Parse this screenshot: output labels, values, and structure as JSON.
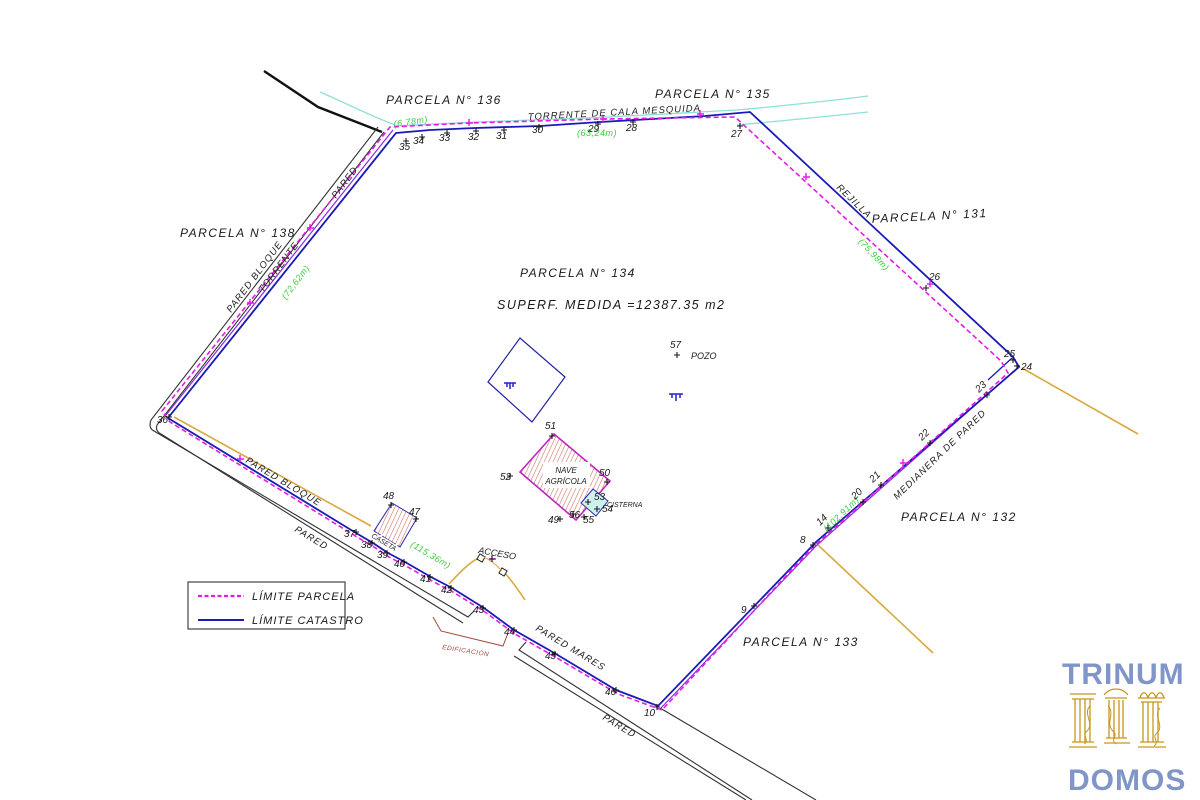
{
  "colors": {
    "limite_parcela": "#e61ae6",
    "limite_catastro": "#1a1ab8",
    "violet_overlap": "#8a2be2",
    "stream_cyan": "#8fe0d8",
    "wall_yellow": "#d9a93f",
    "measure_green": "#3ecc3e",
    "hatch_red": "#cc6a5c",
    "edificacion_red": "#a14a3a",
    "road_black": "#333333",
    "logo_blue": "#8095c8",
    "logo_gold": "#c8961e"
  },
  "parcels": [
    {
      "t": "PARCELA N° 136",
      "x": 386,
      "y": 104,
      "r": 0
    },
    {
      "t": "PARCELA N° 135",
      "x": 655,
      "y": 98,
      "r": 0
    },
    {
      "t": "PARCELA N° 131",
      "x": 872,
      "y": 223,
      "r": -3
    },
    {
      "t": "PARCELA N° 138",
      "x": 180,
      "y": 237,
      "r": 0
    },
    {
      "t": "PARCELA N° 134",
      "x": 520,
      "y": 277,
      "r": 0
    },
    {
      "t": "PARCELA N° 132",
      "x": 901,
      "y": 521,
      "r": 0
    },
    {
      "t": "PARCELA N° 133",
      "x": 743,
      "y": 646,
      "r": 0
    }
  ],
  "superf": "SUPERF.  MEDIDA  =12387.35  m2",
  "labels": [
    {
      "t": "TORRENTE  DE  CALA  MESQUIDA",
      "x": 528,
      "y": 120,
      "r": -3
    },
    {
      "t": "PARED",
      "x": 336,
      "y": 199,
      "r": -53
    },
    {
      "t": "TORRENTE",
      "x": 263,
      "y": 293,
      "r": -53
    },
    {
      "t": "PARED  BLOQUE",
      "x": 231,
      "y": 313,
      "r": -53
    },
    {
      "t": "REJILLA",
      "x": 836,
      "y": 188,
      "r": 44
    },
    {
      "t": "MEDIANERA  DE  PARED",
      "x": 897,
      "y": 500,
      "r": -44
    },
    {
      "t": "PARED  BLOQUE",
      "x": 245,
      "y": 462,
      "r": 31
    },
    {
      "t": "PARED",
      "x": 294,
      "y": 531,
      "r": 31
    },
    {
      "t": "PARED  MARES",
      "x": 535,
      "y": 630,
      "r": 31
    },
    {
      "t": "PARED",
      "x": 602,
      "y": 719,
      "r": 31
    }
  ],
  "measurements": [
    {
      "t": "(6,78m)",
      "x": 394,
      "y": 127,
      "r": -8
    },
    {
      "t": "(63,24m)",
      "x": 577,
      "y": 136,
      "r": 0
    },
    {
      "t": "(75,98m)",
      "x": 858,
      "y": 242,
      "r": 47
    },
    {
      "t": "(72,62m)",
      "x": 286,
      "y": 300,
      "r": -53
    },
    {
      "t": "(115,36m)",
      "x": 410,
      "y": 546,
      "r": 31
    },
    {
      "t": "(102,91m)",
      "x": 827,
      "y": 532,
      "r": -44
    }
  ],
  "vertices": [
    {
      "t": "8",
      "x": 800,
      "y": 543,
      "m": [
        813,
        545
      ]
    },
    {
      "t": "9",
      "x": 741,
      "y": 613,
      "m": [
        754,
        606
      ]
    },
    {
      "t": "10",
      "x": 644,
      "y": 716,
      "m": [
        657,
        707
      ]
    },
    {
      "t": "14",
      "x": 820,
      "y": 526,
      "r": -44,
      "m": [
        828,
        528
      ]
    },
    {
      "t": "20",
      "x": 855,
      "y": 500,
      "r": -44,
      "m": [
        863,
        502
      ]
    },
    {
      "t": "21",
      "x": 873,
      "y": 483,
      "r": -44,
      "m": [
        881,
        485
      ]
    },
    {
      "t": "22",
      "x": 922,
      "y": 441,
      "r": -44,
      "m": [
        930,
        443
      ]
    },
    {
      "t": "23",
      "x": 979,
      "y": 393,
      "r": -44,
      "m": [
        987,
        395
      ]
    },
    {
      "t": "24",
      "x": 1021,
      "y": 370,
      "m": [
        1017,
        366
      ]
    },
    {
      "t": "25",
      "x": 1004,
      "y": 357,
      "m": [
        1013,
        360
      ]
    },
    {
      "t": "26",
      "x": 929,
      "y": 280,
      "m": [
        926,
        288
      ]
    },
    {
      "t": "27",
      "x": 731,
      "y": 137,
      "m": [
        740,
        126
      ]
    },
    {
      "t": "28",
      "x": 626,
      "y": 131,
      "m": [
        633,
        122
      ]
    },
    {
      "t": "29",
      "x": 588,
      "y": 132,
      "m": [
        598,
        124
      ]
    },
    {
      "t": "30",
      "x": 532,
      "y": 133,
      "m": [
        539,
        127
      ]
    },
    {
      "t": "31",
      "x": 496,
      "y": 139,
      "m": [
        504,
        130
      ]
    },
    {
      "t": "32",
      "x": 468,
      "y": 140,
      "m": [
        476,
        131
      ]
    },
    {
      "t": "33",
      "x": 439,
      "y": 141,
      "m": [
        447,
        133
      ]
    },
    {
      "t": "34",
      "x": 413,
      "y": 144,
      "m": [
        422,
        137
      ]
    },
    {
      "t": "35",
      "x": 399,
      "y": 150,
      "m": [
        406,
        141
      ]
    },
    {
      "t": "36",
      "x": 157,
      "y": 423,
      "m": [
        169,
        417
      ]
    },
    {
      "t": "37",
      "x": 344,
      "y": 537,
      "m": [
        356,
        532
      ]
    },
    {
      "t": "38",
      "x": 361,
      "y": 548,
      "m": [
        372,
        543
      ]
    },
    {
      "t": "39",
      "x": 377,
      "y": 558,
      "m": [
        387,
        553
      ]
    },
    {
      "t": "40",
      "x": 394,
      "y": 567,
      "m": [
        404,
        562
      ]
    },
    {
      "t": "41",
      "x": 420,
      "y": 582,
      "m": [
        430,
        577
      ]
    },
    {
      "t": "42",
      "x": 441,
      "y": 593,
      "m": [
        451,
        588
      ]
    },
    {
      "t": "43",
      "x": 473,
      "y": 613,
      "m": [
        483,
        608
      ]
    },
    {
      "t": "44",
      "x": 504,
      "y": 635,
      "m": [
        514,
        630
      ]
    },
    {
      "t": "45",
      "x": 545,
      "y": 659,
      "m": [
        555,
        654
      ]
    },
    {
      "t": "46",
      "x": 605,
      "y": 695,
      "m": [
        616,
        690
      ]
    },
    {
      "t": "47",
      "x": 409,
      "y": 515,
      "m": [
        416,
        519
      ]
    },
    {
      "t": "48",
      "x": 383,
      "y": 499,
      "m": [
        391,
        505
      ]
    },
    {
      "t": "49",
      "x": 548,
      "y": 523,
      "m": [
        560,
        519
      ]
    },
    {
      "t": "50",
      "x": 599,
      "y": 476,
      "m": [
        607,
        482
      ]
    },
    {
      "t": "51",
      "x": 545,
      "y": 429,
      "m": [
        552,
        436
      ]
    },
    {
      "t": "52",
      "x": 500,
      "y": 480,
      "m": [
        510,
        476
      ]
    },
    {
      "t": "53",
      "x": 594,
      "y": 500,
      "m": [
        588,
        502
      ]
    },
    {
      "t": "54",
      "x": 602,
      "y": 512,
      "m": [
        597,
        509
      ]
    },
    {
      "t": "55",
      "x": 583,
      "y": 523,
      "m": [
        584,
        517
      ]
    },
    {
      "t": "56",
      "x": 569,
      "y": 518,
      "m": [
        573,
        514
      ]
    },
    {
      "t": "57",
      "x": 670,
      "y": 348,
      "m": [
        677,
        355
      ]
    }
  ],
  "features": {
    "pozo": "POZO",
    "nave1": "NAVE",
    "nave2": "AGRÍCOLA",
    "cisterna": "CISTERNA",
    "caseta": "CASETA",
    "acceso": "ACCESO",
    "edificacion": "EDIFICACIÓN"
  },
  "legend": {
    "items": [
      {
        "label": "LÍMITE  PARCELA"
      },
      {
        "label": "LÍMITE  CATASTRO"
      }
    ]
  },
  "logo": {
    "line1": "TRINUM",
    "line2": "DOMOS"
  }
}
